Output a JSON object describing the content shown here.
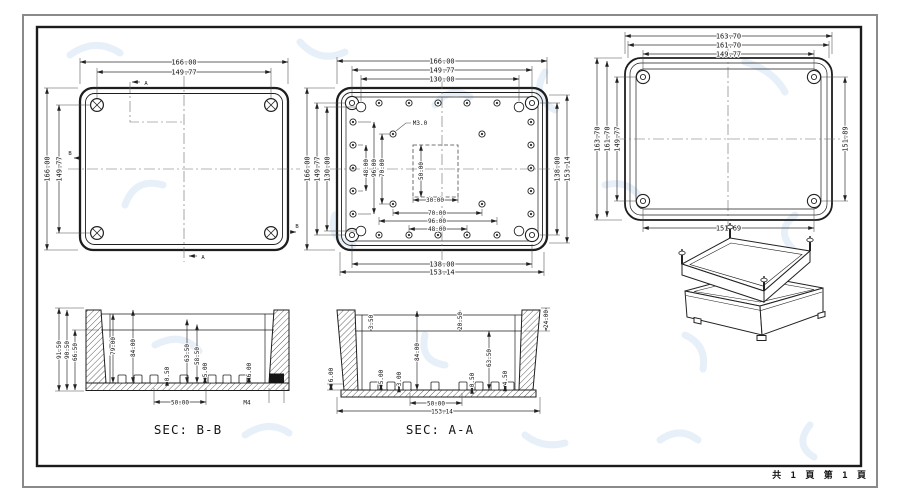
{
  "colors": {
    "line": "#1e1e1e",
    "dim_text": "#141414",
    "border_outer": "#8a8a8a",
    "border_inner": "#1c1c1c",
    "watermark": "#cfe2f2",
    "paper": "#ffffff"
  },
  "v1": {
    "dim_top": [
      "166.00",
      "149.77"
    ],
    "dim_left": [
      "166.00",
      "149.77"
    ],
    "section_a": "A",
    "section_b": "B"
  },
  "v2": {
    "thread": "M3.0",
    "dim_top": [
      "166.00",
      "149.77",
      "130.00"
    ],
    "dim_left": [
      "166.00",
      "149.77",
      "130.00"
    ],
    "dim_left_inner": [
      "48.00",
      "96.00",
      "70.00"
    ],
    "dim_pocket": "50.00",
    "dim_bottom_inner": [
      "30.00",
      "70.00",
      "96.00",
      "48.00"
    ],
    "dim_bottom": [
      "138.00",
      "153.14"
    ],
    "dim_right": [
      "138.00",
      "153.14"
    ]
  },
  "v3": {
    "dim_top": [
      "163.70",
      "161.70",
      "149.77"
    ],
    "dim_left": [
      "163.70",
      "161.70",
      "149.77"
    ],
    "dim_right": "151.89",
    "dim_bottom": "151.69"
  },
  "bb": {
    "label": "SEC: B-B",
    "dim_left": [
      "91.50",
      "90.50",
      "66.50"
    ],
    "dim_inner": [
      "79.00",
      "84.00",
      "63.50",
      "58.50",
      "5.00",
      "0.50",
      "6.00"
    ],
    "dim_bottom": "50.00",
    "thread": "M4"
  },
  "aa": {
    "label": "SEC: A-A",
    "dim_top": [
      "3.50",
      "20.50",
      "24.00"
    ],
    "dim_inner": [
      "84.00",
      "63.50",
      "6.00",
      "5.00",
      "3.00",
      "0.50",
      "4.50"
    ],
    "dim_bottom": [
      "50.00",
      "153.14"
    ]
  },
  "footer": {
    "pages": "共 1 頁  第 1 頁"
  }
}
